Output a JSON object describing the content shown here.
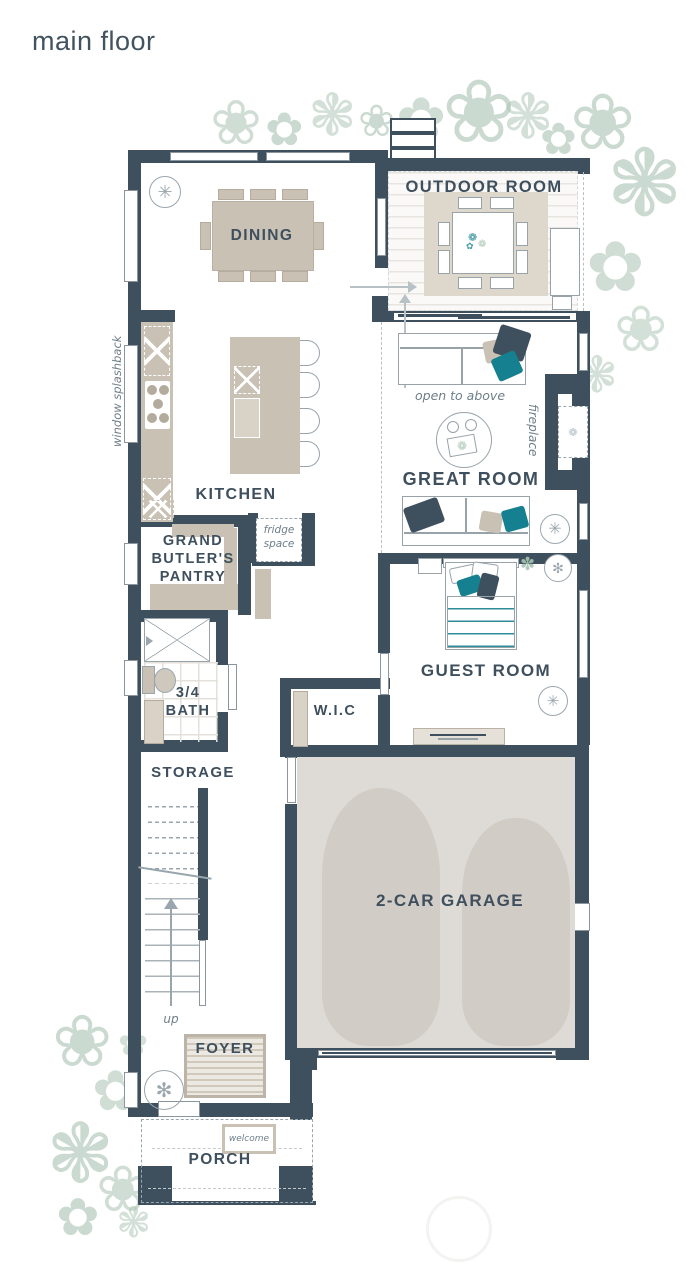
{
  "title": "main floor",
  "colors": {
    "wall": "#3E4F5D",
    "teal_accent": "#15808F",
    "furniture_beige": "#C9C1B3",
    "plant_sage": "#A8C3B2",
    "garage_floor": "#DEDAD6",
    "annotation_gray": "#6E7E89"
  },
  "rooms": {
    "dining": "DINING",
    "outdoor_room": "OUTDOOR ROOM",
    "kitchen": "KITCHEN",
    "pantry": "GRAND BUTLER'S PANTRY",
    "great_room": "GREAT ROOM",
    "guest_room": "GUEST ROOM",
    "bath": "3/4 BATH",
    "wic": "W.I.C",
    "storage": "STORAGE",
    "garage": "2-CAR GARAGE",
    "foyer": "FOYER",
    "porch": "PORCH"
  },
  "annotations": {
    "window_splashback": "window splashback",
    "open_to_above": "open to above",
    "fireplace": "fireplace",
    "fridge_space": "fridge space",
    "up": "up",
    "welcome": "welcome"
  }
}
